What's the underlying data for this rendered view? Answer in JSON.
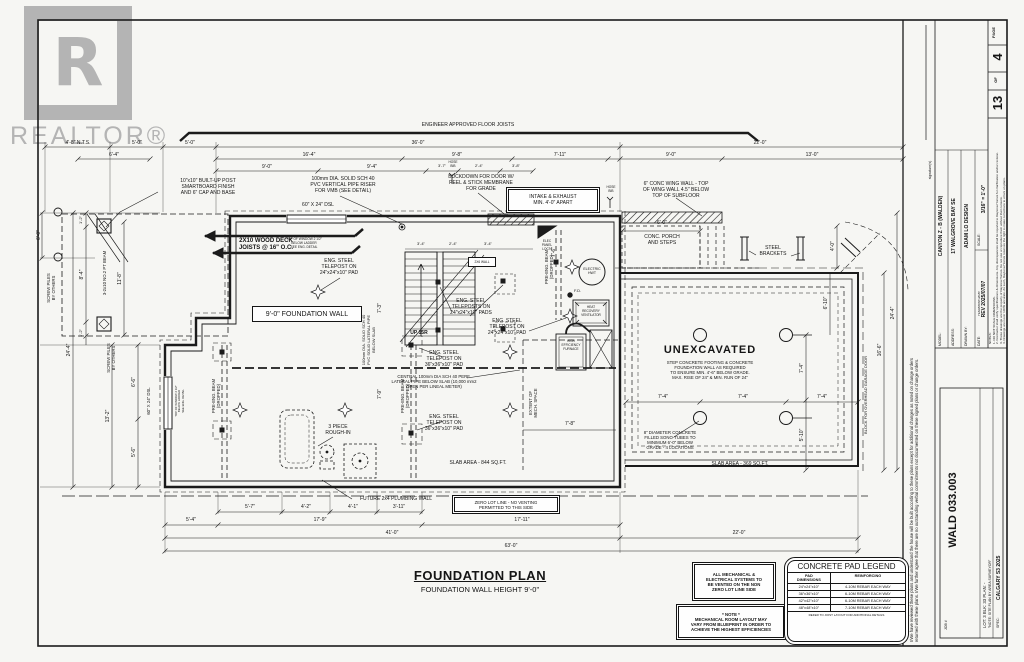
{
  "watermark": {
    "letter": "R",
    "brand": "REALTOR®"
  },
  "plan_title": {
    "title": "FOUNDATION PLAN",
    "subtitle": "FOUNDATION WALL HEIGHT 9'-0\""
  },
  "ann": {
    "joists": "ENGINEER APPROVED FLOOR JOISTS",
    "built_up_post": "10\"x10\" BUILT-UP POST\nSMARTBOARD FINISH\nAND 6\" CAP AND BASE",
    "pvc_riser": "100mm DIA. SOLID SCH 40\nPVC VERTICAL PIPE RISER\nFOR VMB (SEE DETAIL)",
    "buckdown": "BUCKDOWN FOR DOOR W/\nPEEL & STICK MEMBRANE\nFOR GRADE",
    "intake": "INTAKE & EXHAUST\nMIN. 4'-0\" APART",
    "wing_wall": "6\" CONC WING WALL - TOP\nOF WING WALL 4.5\" BELOW\nTOP OF SUBFLOOR",
    "deck": "2X10 WOOD DECK\nJOISTS @ 16\" O.C.",
    "dsl_top": "60\" X 24\" DSL",
    "window_note": "TOP OF WINDOW 2 1/2\"\nBELOW LADDER\nSEE ENG. DETAIL",
    "porch_dim": "6'-0\"",
    "porch": "CONC. PORCH\nAND STEPS",
    "brackets": "STEEL\nBRACKETS",
    "hose_bib": "HOSE\nBIB",
    "found_wall": "9'-0\" FOUNDATION WALL",
    "telepost24": "ENG. STEEL\nTELEPOST ON\n24\"x24\"x10\" PAD",
    "teleposts24": "ENG. STEEL\nTELEPOSTS ON\n24\"x24\"x10\" PADS",
    "telepost36": "ENG. STEEL\nTELEPOST ON\n36\"x36\"x10\" PAD",
    "elec_panel": "ELEC\nPANEL\nLOC'N",
    "beam": "PRE-ENG. BEAM\n(DROPPED)",
    "hwt": "ELECTRIC\nHWT",
    "up15r": "UP 15R",
    "wall2x6": "2X6 WALL",
    "central_pipe": "CENTRAL 100mm DIA SCH 40 PERF.\nLATERAL PIPE BELOW SLAB (10,000 mm2\nOPEN PER LINEAL METER)",
    "lateral_pipe": "100mm DIA. SOLID SCH 40\nPVC SOLID LATERAL PIPE\nBELOW SLAB",
    "extent_mech": "EXTENT OF\nMECH. SPACE",
    "rough_in": "3 PIECE\nROUGH-IN",
    "future_wall": "FUTURE 2x4 PLUMBING WALL",
    "unexcavated": "UNEXCAVATED",
    "step_footing": "STEP CONCRETE FOOTING & CONCRETE\nFOUNDATION WALL AS REQUIRED\nTO ENSURE MIN. 4'-6\" BELOW GRADE.\nMAX. RISE OF 24\" & MIN. RUN OF 24\"",
    "sono": "8\" DIAMETER CONCRETE\nFILLED SONO-TUBES TO\nMINIMUM 6'-0\" BELOW\nGRADE - 4 LOCATIONS",
    "slab_main": "SLAB AREA - 844 SQ.FT.",
    "slab_garage": "SLAB AREA - 369 SQ.FT.",
    "block_door": "BLOCK FOR OVERHEAD GARAGE DOOR",
    "zero_lot": "ZERO LOT LINE - NO VENTING\nPERMITTED TO THIS SIDE",
    "screw_piles": "SCREW PILES\nBY OTHERS",
    "pt_beam": "3-2x10 NO.2 PT BEAM",
    "dsl_left": "60\" X 24\" DSL",
    "hrv": "HEAT\nRECOVERY\nVENTILATOR",
    "furnace": "HIGH\nEFFICIENCY\nFURNACE",
    "fd": "F.D."
  },
  "dims": {
    "top1": [
      "4'-8\" N.T.S.",
      "5'-0\"",
      "5'-0\"",
      "36'-0\"",
      "22'-0\""
    ],
    "top2": [
      "6'-4\"",
      "16'-4\"",
      "9'-8\"",
      "7'-11\"",
      "9'-0\"",
      "13'-0\""
    ],
    "top3": [
      "9'-0\"",
      "9'-4\"",
      "3'-7\"",
      "2'-4\"",
      "3'-8\""
    ],
    "bot1": [
      "5'-7\"",
      "4'-2\"",
      "4'-1\"",
      "3'-11\""
    ],
    "bot2": [
      "5'-4\"",
      "17'-9\"",
      "17'-11\""
    ],
    "bot3": [
      "41'-0\"",
      "22'-0\""
    ],
    "bot4": [
      "63'-0\""
    ],
    "left": [
      "6'-0\"",
      "1'-2\"",
      "8'-4\"",
      "1'-2\"",
      "24'-4\"",
      "11'-8\"",
      "13'-2\"",
      "6'-6\"",
      "5'-6\""
    ],
    "right": [
      "4'-0\"",
      "6'-10\"",
      "7'-4\"",
      "5'-10\"",
      "16'-6\"",
      "24'-4\""
    ],
    "garage": [
      "7'-4\"",
      "7'-4\"",
      "7'-4\""
    ],
    "inner": [
      "7'-3\"",
      "7'-9\"",
      "7'-6\"",
      "7'-8\"",
      "3'-4\"",
      "2'-4\"",
      "3'-4\""
    ]
  },
  "legend": {
    "title": "CONCRETE PAD LEGEND",
    "col1": "PAD\nDIMENSIONS",
    "col2": "REINFORCING",
    "rows": [
      [
        "24\"x24\"x10\"",
        "4-10M REBAR EACH WAY"
      ],
      [
        "36\"x36\"x10\"",
        "6-10M REBAR EACH WAY"
      ],
      [
        "42\"x42\"x10\"",
        "6-10M REBAR EACH WAY"
      ],
      [
        "48\"x48\"x10\"",
        "7-10M REBAR EACH WAY"
      ]
    ],
    "footer": "REFER TO JOIST LAYOUT FOR ADDITIONAL DETAILS"
  },
  "notes_boxes": {
    "vent": "ALL MECHANICAL &\nELECTRICAL SYSTEMS TO\nBE VENTED ON THE NON\nZERO LOT LINE SIDE",
    "note_title": "* NOTE *",
    "note_body": "MECHANICAL ROOM LAYOUT MAY\nVARY FROM BLUEPRINT IN ORDER TO\nACHIEVE THE HIGHEST EFFICIENCIES"
  },
  "title_block": {
    "page_label": "PAGE",
    "page": "4",
    "of_label": "OF",
    "total": "13",
    "notes": "NOTES:\n1. DO NOT SCALE DIMENSIONS.\n2. Contractor shall verify specifications & dimensions. Any discrepancies shall be reported to Daytona Homes for clarification and/or revision.\n3. These drawings are the property of Daytona Homes. Do not use or reproduce them without their consent.\n4. Drawings are never 100% accurate. As such, Daytona Homes reserves the right to make corrections to errors on plans.",
    "model_label": "MODEL:",
    "model": "CANYON Z - B (WALDEN)",
    "address_label": "ADDRESS:",
    "address": "17 WALGROVE BAY SE",
    "drawn_label": "DRAWN BY:",
    "drawn": "ADAM LO DESIGN",
    "scale_label": "SCALE:",
    "scale": "3/16\" = 1'-0\"",
    "date_label": "DATE:",
    "date_sub": "YEAR/MONTH/DAY",
    "date": "REV 2025/07/07",
    "job_label": "JOB #",
    "job": "WALD 033.003",
    "lot_line": "LOT: 3    BLK: 33    PLAN: -",
    "site_note": "\"NOTE: SITE PLAN BY AREA SURVEYOR\"",
    "spec_label": "SPEC:",
    "spec": "CALGARY S3 2025",
    "signature": "signature(s)",
    "disclaimer": "I/We have reviewed these plans and understand the house will be built according to these plans except for additional changes as noted on change orders returned with these plans. I/We further agree that there are no outstanding verbal commitments not documented on these signed plans or change orders."
  }
}
